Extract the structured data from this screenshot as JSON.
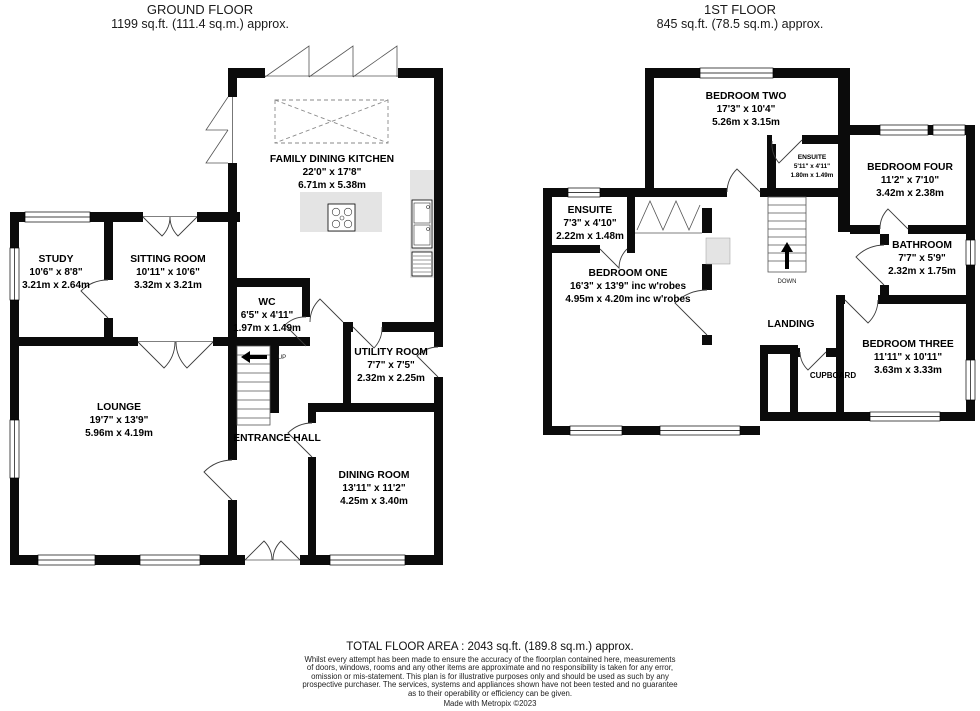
{
  "ground_floor": {
    "title": "GROUND FLOOR",
    "subtitle": "1199 sq.ft. (111.4 sq.m.) approx.",
    "stair_label": "UP",
    "rooms": {
      "kitchen": {
        "name": "FAMILY DINING KITCHEN",
        "imperial": "22'0\" x 17'8\"",
        "metric": "6.71m x 5.38m"
      },
      "study": {
        "name": "STUDY",
        "imperial": "10'6\" x 8'8\"",
        "metric": "3.21m x 2.64m"
      },
      "sitting_room": {
        "name": "SITTING ROOM",
        "imperial": "10'11\" x 10'6\"",
        "metric": "3.32m x 3.21m"
      },
      "wc": {
        "name": "WC",
        "imperial": "6'5\" x 4'11\"",
        "metric": "1.97m x 1.49m"
      },
      "utility_room": {
        "name": "UTILITY ROOM",
        "imperial": "7'7\" x 7'5\"",
        "metric": "2.32m x 2.25m"
      },
      "lounge": {
        "name": "LOUNGE",
        "imperial": "19'7\" x 13'9\"",
        "metric": "5.96m x 4.19m"
      },
      "entrance_hall": {
        "name": "ENTRANCE HALL"
      },
      "dining_room": {
        "name": "DINING ROOM",
        "imperial": "13'11\" x 11'2\"",
        "metric": "4.25m x 3.40m"
      }
    }
  },
  "first_floor": {
    "title": "1ST FLOOR",
    "subtitle": "845 sq.ft. (78.5 sq.m.) approx.",
    "stair_label": "DOWN",
    "rooms": {
      "bedroom_two": {
        "name": "BEDROOM TWO",
        "imperial": "17'3\" x 10'4\"",
        "metric": "5.26m x 3.15m"
      },
      "ensuite_two": {
        "name": "ENSUITE",
        "imperial": "5'11\" x 4'11\"",
        "metric": "1.80m x 1.49m"
      },
      "bedroom_four": {
        "name": "BEDROOM FOUR",
        "imperial": "11'2\" x 7'10\"",
        "metric": "3.42m x 2.38m"
      },
      "ensuite_one": {
        "name": "ENSUITE",
        "imperial": "7'3\" x 4'10\"",
        "metric": "2.22m x 1.48m"
      },
      "bedroom_one": {
        "name": "BEDROOM ONE",
        "imperial": "16'3\" x 13'9\" inc w'robes",
        "metric": "4.95m x 4.20m inc w'robes"
      },
      "bathroom": {
        "name": "BATHROOM",
        "imperial": "7'7\" x 5'9\"",
        "metric": "2.32m x 1.75m"
      },
      "landing": {
        "name": "LANDING"
      },
      "bedroom_three": {
        "name": "BEDROOM THREE",
        "imperial": "11'11\" x 10'11\"",
        "metric": "3.63m x 3.33m"
      },
      "cupboard": {
        "name": "CUPBOARD"
      }
    }
  },
  "footer": {
    "total_area": "TOTAL FLOOR AREA : 2043 sq.ft. (189.8 sq.m.) approx.",
    "disclaimer_lines": [
      "Whilst every attempt has been made to ensure the accuracy of the floorplan contained here, measurements",
      "of doors, windows, rooms and any other items are approximate and no responsibility is taken for any error,",
      "omission or mis-statement. This plan is for illustrative purposes only and should be used as such by any",
      "prospective purchaser. The services, systems and appliances shown have not been tested and no guarantee",
      "as to their operability or efficiency can be given."
    ],
    "credit": "Made with Metropix ©2023"
  },
  "colors": {
    "wall": "#0b0b0b",
    "counter": "#e4e4e4",
    "background": "#ffffff"
  }
}
